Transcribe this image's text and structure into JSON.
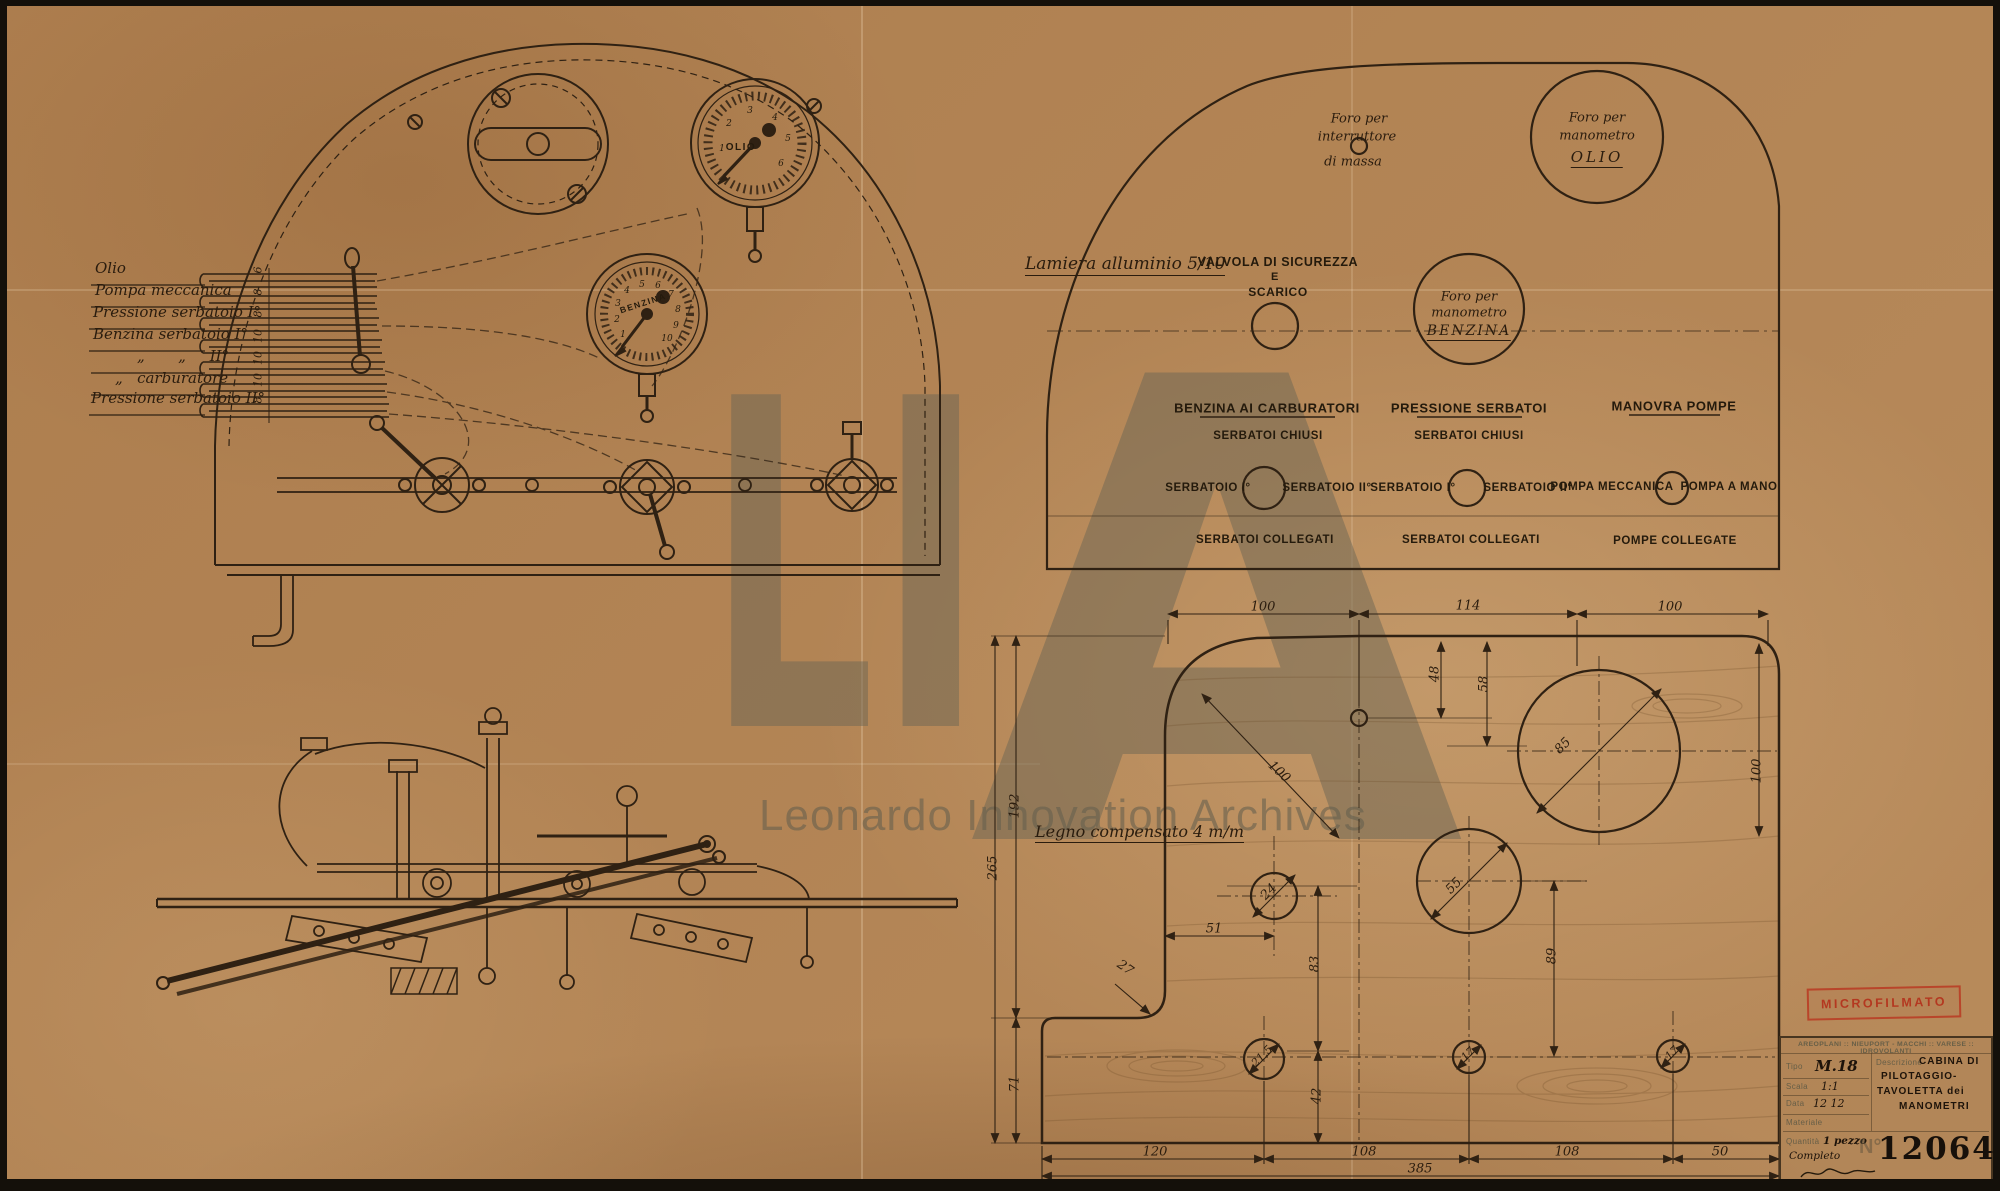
{
  "watermark": {
    "l": "L",
    "i": "I",
    "a": "A",
    "caption": "Leonardo Innovation Archives"
  },
  "stamp": {
    "label": "MICROFILMATO",
    "color": "#ba3a22"
  },
  "front_view": {
    "pipe_labels": [
      {
        "label": "Olio",
        "size": "6"
      },
      {
        "label": "Pompa meccanica",
        "size": "8"
      },
      {
        "label": "Pressione serbatoio I°",
        "size": "8"
      },
      {
        "label": "Benzina serbatoio I°",
        "size": "10"
      },
      {
        "label": "„       „     II°",
        "size": "10"
      },
      {
        "label": "„   carburatore",
        "size": "10"
      },
      {
        "label": "Pressione serbatoio II°",
        "size": "8"
      }
    ],
    "gauge_olio": {
      "label": "OLIO",
      "ticks": [
        "1",
        "2",
        "3",
        "4",
        "5",
        "6"
      ]
    },
    "gauge_benzina": {
      "label": "BENZINA",
      "ticks": [
        "1",
        "2",
        "3",
        "4",
        "5",
        "6",
        "7",
        "8",
        "9",
        "10"
      ]
    }
  },
  "face_view": {
    "material_note": "Lamiera alluminio 5/10",
    "interruttore": {
      "line1": "Foro per",
      "line2": "interruttore",
      "line3": "di massa"
    },
    "olio_hole": {
      "line1": "Foro per",
      "line2": "manometro",
      "line3": "OLIO"
    },
    "valvola": {
      "line1": "VALVOLA DI SICUREZZA",
      "line2": "E",
      "line3": "SCARICO"
    },
    "benzina_hole": {
      "line1": "Foro per",
      "line2": "manometro",
      "line3": "BENZINA"
    },
    "columns": [
      {
        "title": "BENZINA AI CARBURATORI",
        "top": "SERBATOI CHIUSI",
        "left": "SERBATOIO I°",
        "right": "SERBATOIO II°",
        "bottom": "SERBATOI COLLEGATI"
      },
      {
        "title": "PRESSIONE SERBATOI",
        "top": "SERBATOI CHIUSI",
        "left": "SERBATOIO I°",
        "right": "SERBATOIO II°",
        "bottom": "SERBATOI COLLEGATI"
      },
      {
        "title": "MANOVRA POMPE",
        "top": "",
        "left": "POMPA MECCANICA",
        "right": "POMPA A MANO",
        "bottom": "POMPE COLLEGATE"
      }
    ]
  },
  "dim_view": {
    "note": "Legno compensato 4 m/m",
    "top_dims": [
      "100",
      "114",
      "100"
    ],
    "bottom_dims": [
      "120",
      "108",
      "108",
      "50"
    ],
    "bottom_total": "385",
    "left_dims": {
      "outer": "265",
      "upper": "192",
      "lower": "71"
    },
    "inner": {
      "d48": "48",
      "d58": "58",
      "d83": "83",
      "d89": "89",
      "d42": "42",
      "d51": "51"
    },
    "radii": {
      "top_corner": "100",
      "bottom_corner": "27",
      "right_edge": "100"
    },
    "holes": {
      "olio": "85",
      "benzina": "55",
      "valvola": "24",
      "left": "21,5",
      "middle": "17",
      "right": "17"
    }
  },
  "title_block": {
    "header": "AREOPLANI :: NIEUPORT - MACCHI :: VARESE :: IDROVOLANTI",
    "tipo_label": "Tipo",
    "tipo": "M.18",
    "scala_label": "Scala",
    "scala": "1:1",
    "data_label": "Data",
    "data": "12 12",
    "materiale_label": "Materiale",
    "descrizione_label": "Descrizione",
    "descrizione_l1": "CABINA DI",
    "descrizione_l2": "PILOTAGGIO-",
    "descrizione_l3": "TAVOLETTA dei",
    "descrizione_l4": "MANOMETRI",
    "quantita_label": "Quantità",
    "quantita": "1 pezzo",
    "quantita2": "Completo",
    "numero_label": "N°",
    "numero": "12064"
  }
}
